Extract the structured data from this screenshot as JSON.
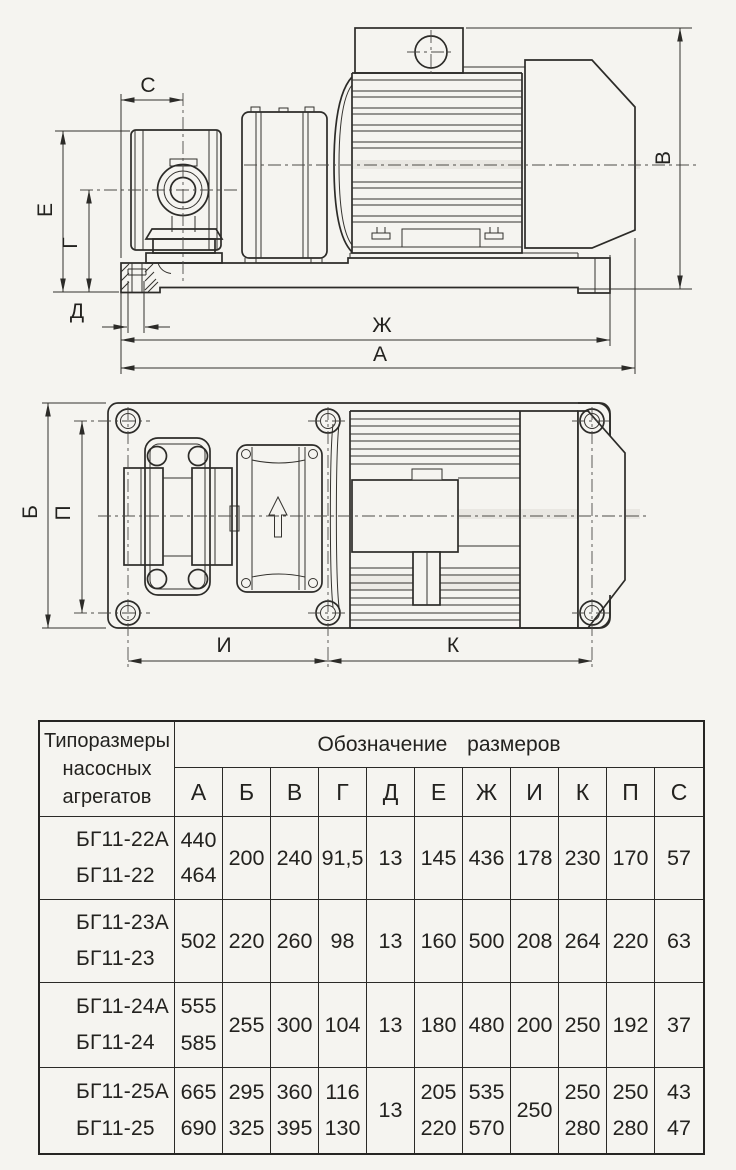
{
  "drawing": {
    "dim_labels": {
      "a": "А",
      "b": "Б",
      "v": "В",
      "g": "Г",
      "d": "Д",
      "e": "Е",
      "zh": "Ж",
      "i": "И",
      "k": "К",
      "p": "П",
      "s": "С"
    }
  },
  "table": {
    "header_lines": [
      "Типоразмеры",
      "насосных",
      "агрегатов"
    ],
    "size_header": "Обозначение размеров",
    "columns": [
      "А",
      "Б",
      "В",
      "Г",
      "Д",
      "Е",
      "Ж",
      "И",
      "К",
      "П",
      "С"
    ],
    "groups": [
      {
        "models": [
          "БГ11-22А",
          "БГ11-22"
        ],
        "cells": [
          [
            "440",
            "464"
          ],
          [
            "200"
          ],
          [
            "240"
          ],
          [
            "91,5"
          ],
          [
            "13"
          ],
          [
            "145"
          ],
          [
            "436"
          ],
          [
            "178"
          ],
          [
            "230"
          ],
          [
            "170"
          ],
          [
            "57"
          ]
        ]
      },
      {
        "models": [
          "БГ11-23А",
          "БГ11-23"
        ],
        "cells": [
          [
            "502"
          ],
          [
            "220"
          ],
          [
            "260"
          ],
          [
            "98"
          ],
          [
            "13"
          ],
          [
            "160"
          ],
          [
            "500"
          ],
          [
            "208"
          ],
          [
            "264"
          ],
          [
            "220"
          ],
          [
            "63"
          ]
        ]
      },
      {
        "models": [
          "БГ11-24А",
          "БГ11-24"
        ],
        "cells": [
          [
            "555",
            "585"
          ],
          [
            "255"
          ],
          [
            "300"
          ],
          [
            "104"
          ],
          [
            "13"
          ],
          [
            "180"
          ],
          [
            "480"
          ],
          [
            "200"
          ],
          [
            "250"
          ],
          [
            "192"
          ],
          [
            "37"
          ]
        ]
      },
      {
        "models": [
          "БГ11-25А",
          "БГ11-25"
        ],
        "cells": [
          [
            "665",
            "690"
          ],
          [
            "295",
            "325"
          ],
          [
            "360",
            "395"
          ],
          [
            "116",
            "130"
          ],
          [
            "13"
          ],
          [
            "205",
            "220"
          ],
          [
            "535",
            "570"
          ],
          [
            "250"
          ],
          [
            "250",
            "280"
          ],
          [
            "250",
            "280"
          ],
          [
            "43",
            "47"
          ]
        ]
      }
    ]
  }
}
